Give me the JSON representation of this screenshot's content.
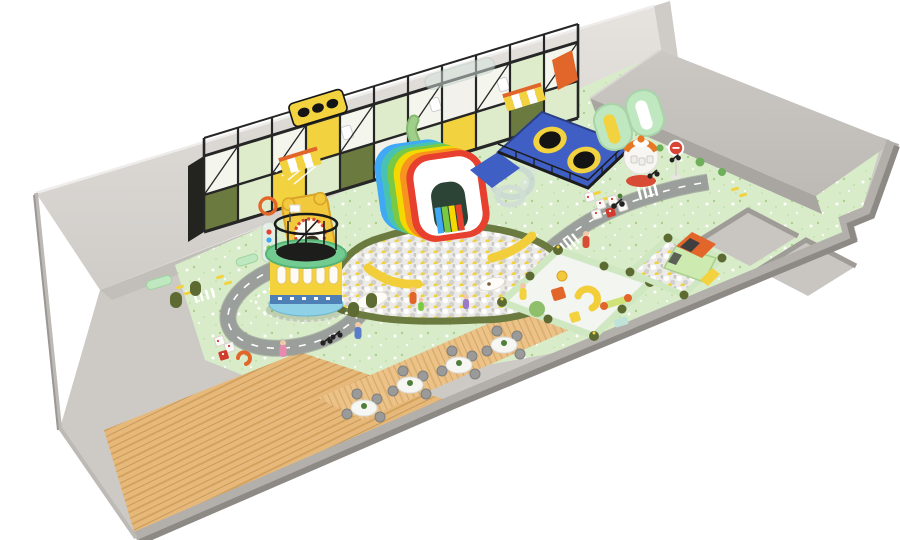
{
  "scene": {
    "description": "3D isometric rendering of an indoor children's soft-play playground floor plan on a white background",
    "areas": [
      "gray entry walkway",
      "two-story black-frame play structure",
      "rainbow arch slide",
      "main ball pit with banana slides",
      "clear spiral tube slide",
      "blue trampoline zone",
      "round carousel climbing tower",
      "ride-on road circuit with roundabout",
      "toddler soft-play pen",
      "ball-pit pen with play car",
      "cafe seating on wood floor",
      "empty sunken pits",
      "raised gray platform",
      "capsule kiosk",
      "stop sign"
    ],
    "counts": {
      "cafe_tables": 4,
      "chairs_per_table": 4,
      "trampolines": 2,
      "rainbow_layers": 6,
      "sunken_pits": 2,
      "striped_awnings": 2,
      "stop_signs": 1,
      "ball_pits": 3,
      "roundabouts": 1,
      "crosswalks": 3
    }
  },
  "colors": {
    "bg": "#ffffff",
    "wall_face": "#dedbd7",
    "wall_cap": "#cfccc8",
    "walkway": "#cdcac6",
    "floor_green": "#d9ecc9",
    "platform_top": "#c6c3bf",
    "platform_side": "#a9a6a2",
    "pit_floor": "#c9c6c2",
    "rim_light": "#b3b0ac",
    "rim_dark": "#8d8a86",
    "road": "#9b9f9c",
    "road_edge": "#8d918e",
    "trampoline_blue": "#3f5fc4",
    "olive": "#6b7a3f",
    "panel_green": "#dfeccb",
    "panel_cream": "#f4f6ee",
    "accent_yellow": "#f2d23e",
    "accent_orange": "#e2662a",
    "pen_wall": "#cfe8c2",
    "pen_post": "#5d6b33",
    "tower_yellow": "#f4d23c",
    "tower_green": "#72cc92",
    "wood_light": "#e6b97b",
    "wood_stripe": "#d4a25f",
    "wood_cafe": "#ecc289",
    "wood_cafe_stripe": "#dcb172",
    "ball_bg": "#ecebe7",
    "mint": "#bfe8c0",
    "rainbow_blue": "#3fa9f5",
    "rainbow_teal": "#49c3b1",
    "rainbow_green": "#7ac943",
    "rainbow_yellow": "#f5d800",
    "rainbow_orange": "#f7931e",
    "rainbow_red": "#e8402f",
    "capsule_red": "#d84b34",
    "capsule_orange": "#e87724",
    "stop_red": "#d94436",
    "pink": "#f2a7c3",
    "skyblue": "#8fd2e8"
  }
}
